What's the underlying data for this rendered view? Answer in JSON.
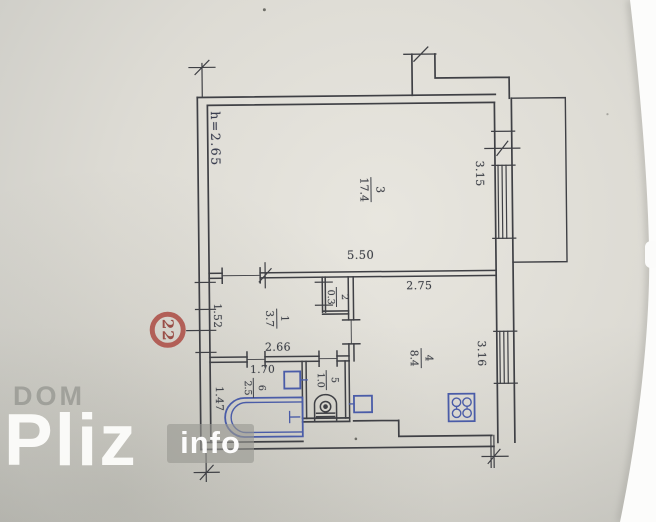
{
  "plan": {
    "ceiling_height": "h=2.65",
    "rooms": [
      {
        "number": "3",
        "area": "17.4"
      },
      {
        "number": "1",
        "area": "3.7"
      },
      {
        "number": "2",
        "area": "0.3"
      },
      {
        "number": "4",
        "area": "8.4"
      },
      {
        "number": "5",
        "area": "1.0"
      },
      {
        "number": "6",
        "area": "2.5"
      }
    ],
    "dimensions": {
      "room3_width": "5.50",
      "room3_depth": "3.15",
      "kitchen_width": "2.75",
      "kitchen_depth": "3.16",
      "hall_width": "2.66",
      "hall_entry": "1.52",
      "bath_width": "1.70",
      "bath_depth": "1.47"
    }
  },
  "stamp": {
    "number": "22"
  },
  "watermark": {
    "brand_top": "DOM",
    "brand_main": "Pliz",
    "brand_badge": "info"
  },
  "colors": {
    "ink": "#3f4045",
    "fixture_blue": "#4a5ca8",
    "stamp_red": "#ad4e48",
    "paper": "#dddbd4"
  }
}
